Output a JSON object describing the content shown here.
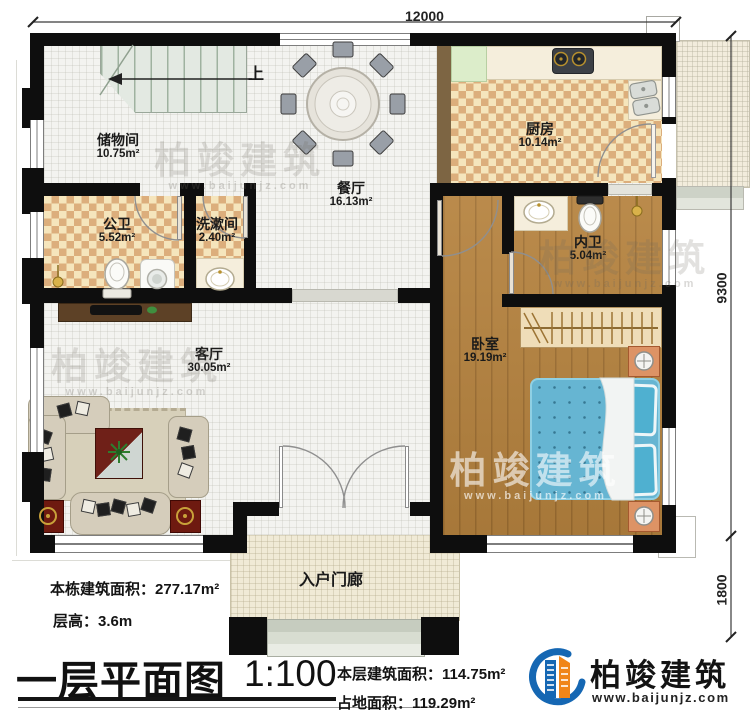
{
  "dimensions": {
    "top": "12000",
    "right_upper": "9300",
    "right_lower": "1800"
  },
  "stairs": {
    "direction_label": "上"
  },
  "rooms": [
    {
      "name": "储物间",
      "area": "10.75m²"
    },
    {
      "name": "公卫",
      "area": "5.52m²"
    },
    {
      "name": "洗漱间",
      "area": "2.40m²"
    },
    {
      "name": "餐厅",
      "area": "16.13m²"
    },
    {
      "name": "厨房",
      "area": "10.14m²"
    },
    {
      "name": "内卫",
      "area": "5.04m²"
    },
    {
      "name": "卧室",
      "area": "19.19m²"
    },
    {
      "name": "客厅",
      "area": "30.05m²"
    },
    {
      "name": "入户门廊",
      "area": ""
    }
  ],
  "title_block": {
    "building_area_label": "本栋建筑面积：",
    "building_area_value": "277.17m²",
    "floor_height_label": "层高：",
    "floor_height_value": "3.6m",
    "plan_title": "一层平面图",
    "scale": "1:100",
    "floor_area_label": "本层建筑面积：",
    "floor_area_value": "114.75m²",
    "land_area_label": "占地面积：",
    "land_area_value": "119.29m²"
  },
  "brand": {
    "name": "柏竣建筑",
    "website": "www.baijunjz.com"
  },
  "watermark": {
    "name": "柏竣建筑",
    "website": "www.baijunjz.com"
  },
  "colors": {
    "wall": "#0e0e0e",
    "checker_dark": "#dcae7c",
    "checker_light": "#f5e5bc",
    "wood": "#b5823e",
    "bed_blue": "#66b5d2",
    "brand_blue": "#1567b3",
    "brand_orange": "#f08519"
  }
}
